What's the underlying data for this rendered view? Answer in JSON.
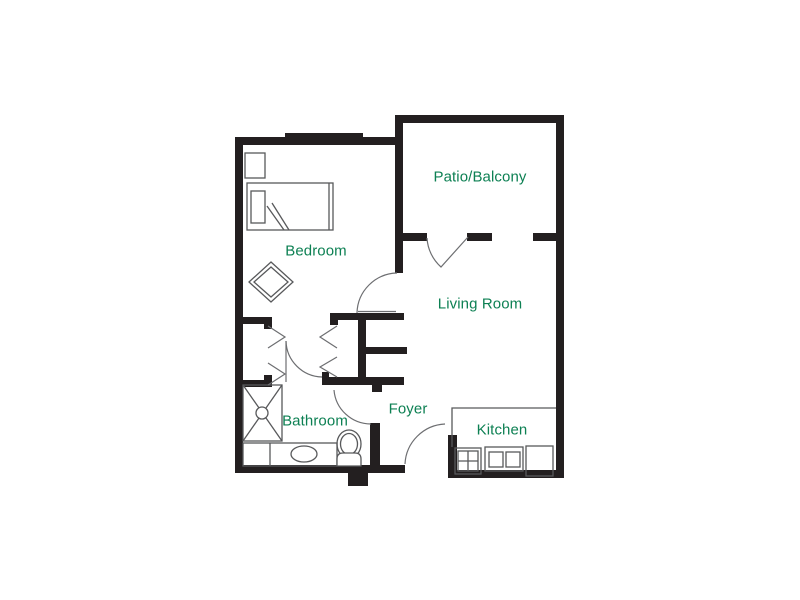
{
  "rooms": {
    "patio_balcony": "Patio/Balcony",
    "bedroom": "Bedroom",
    "living_room": "Living Room",
    "foyer": "Foyer",
    "bathroom": "Bathroom",
    "kitchen": "Kitchen"
  },
  "colors": {
    "wall": "#231f20",
    "line": "#58595b",
    "door": "#6d6e71",
    "label": "#0d8053",
    "background": "#ffffff"
  }
}
